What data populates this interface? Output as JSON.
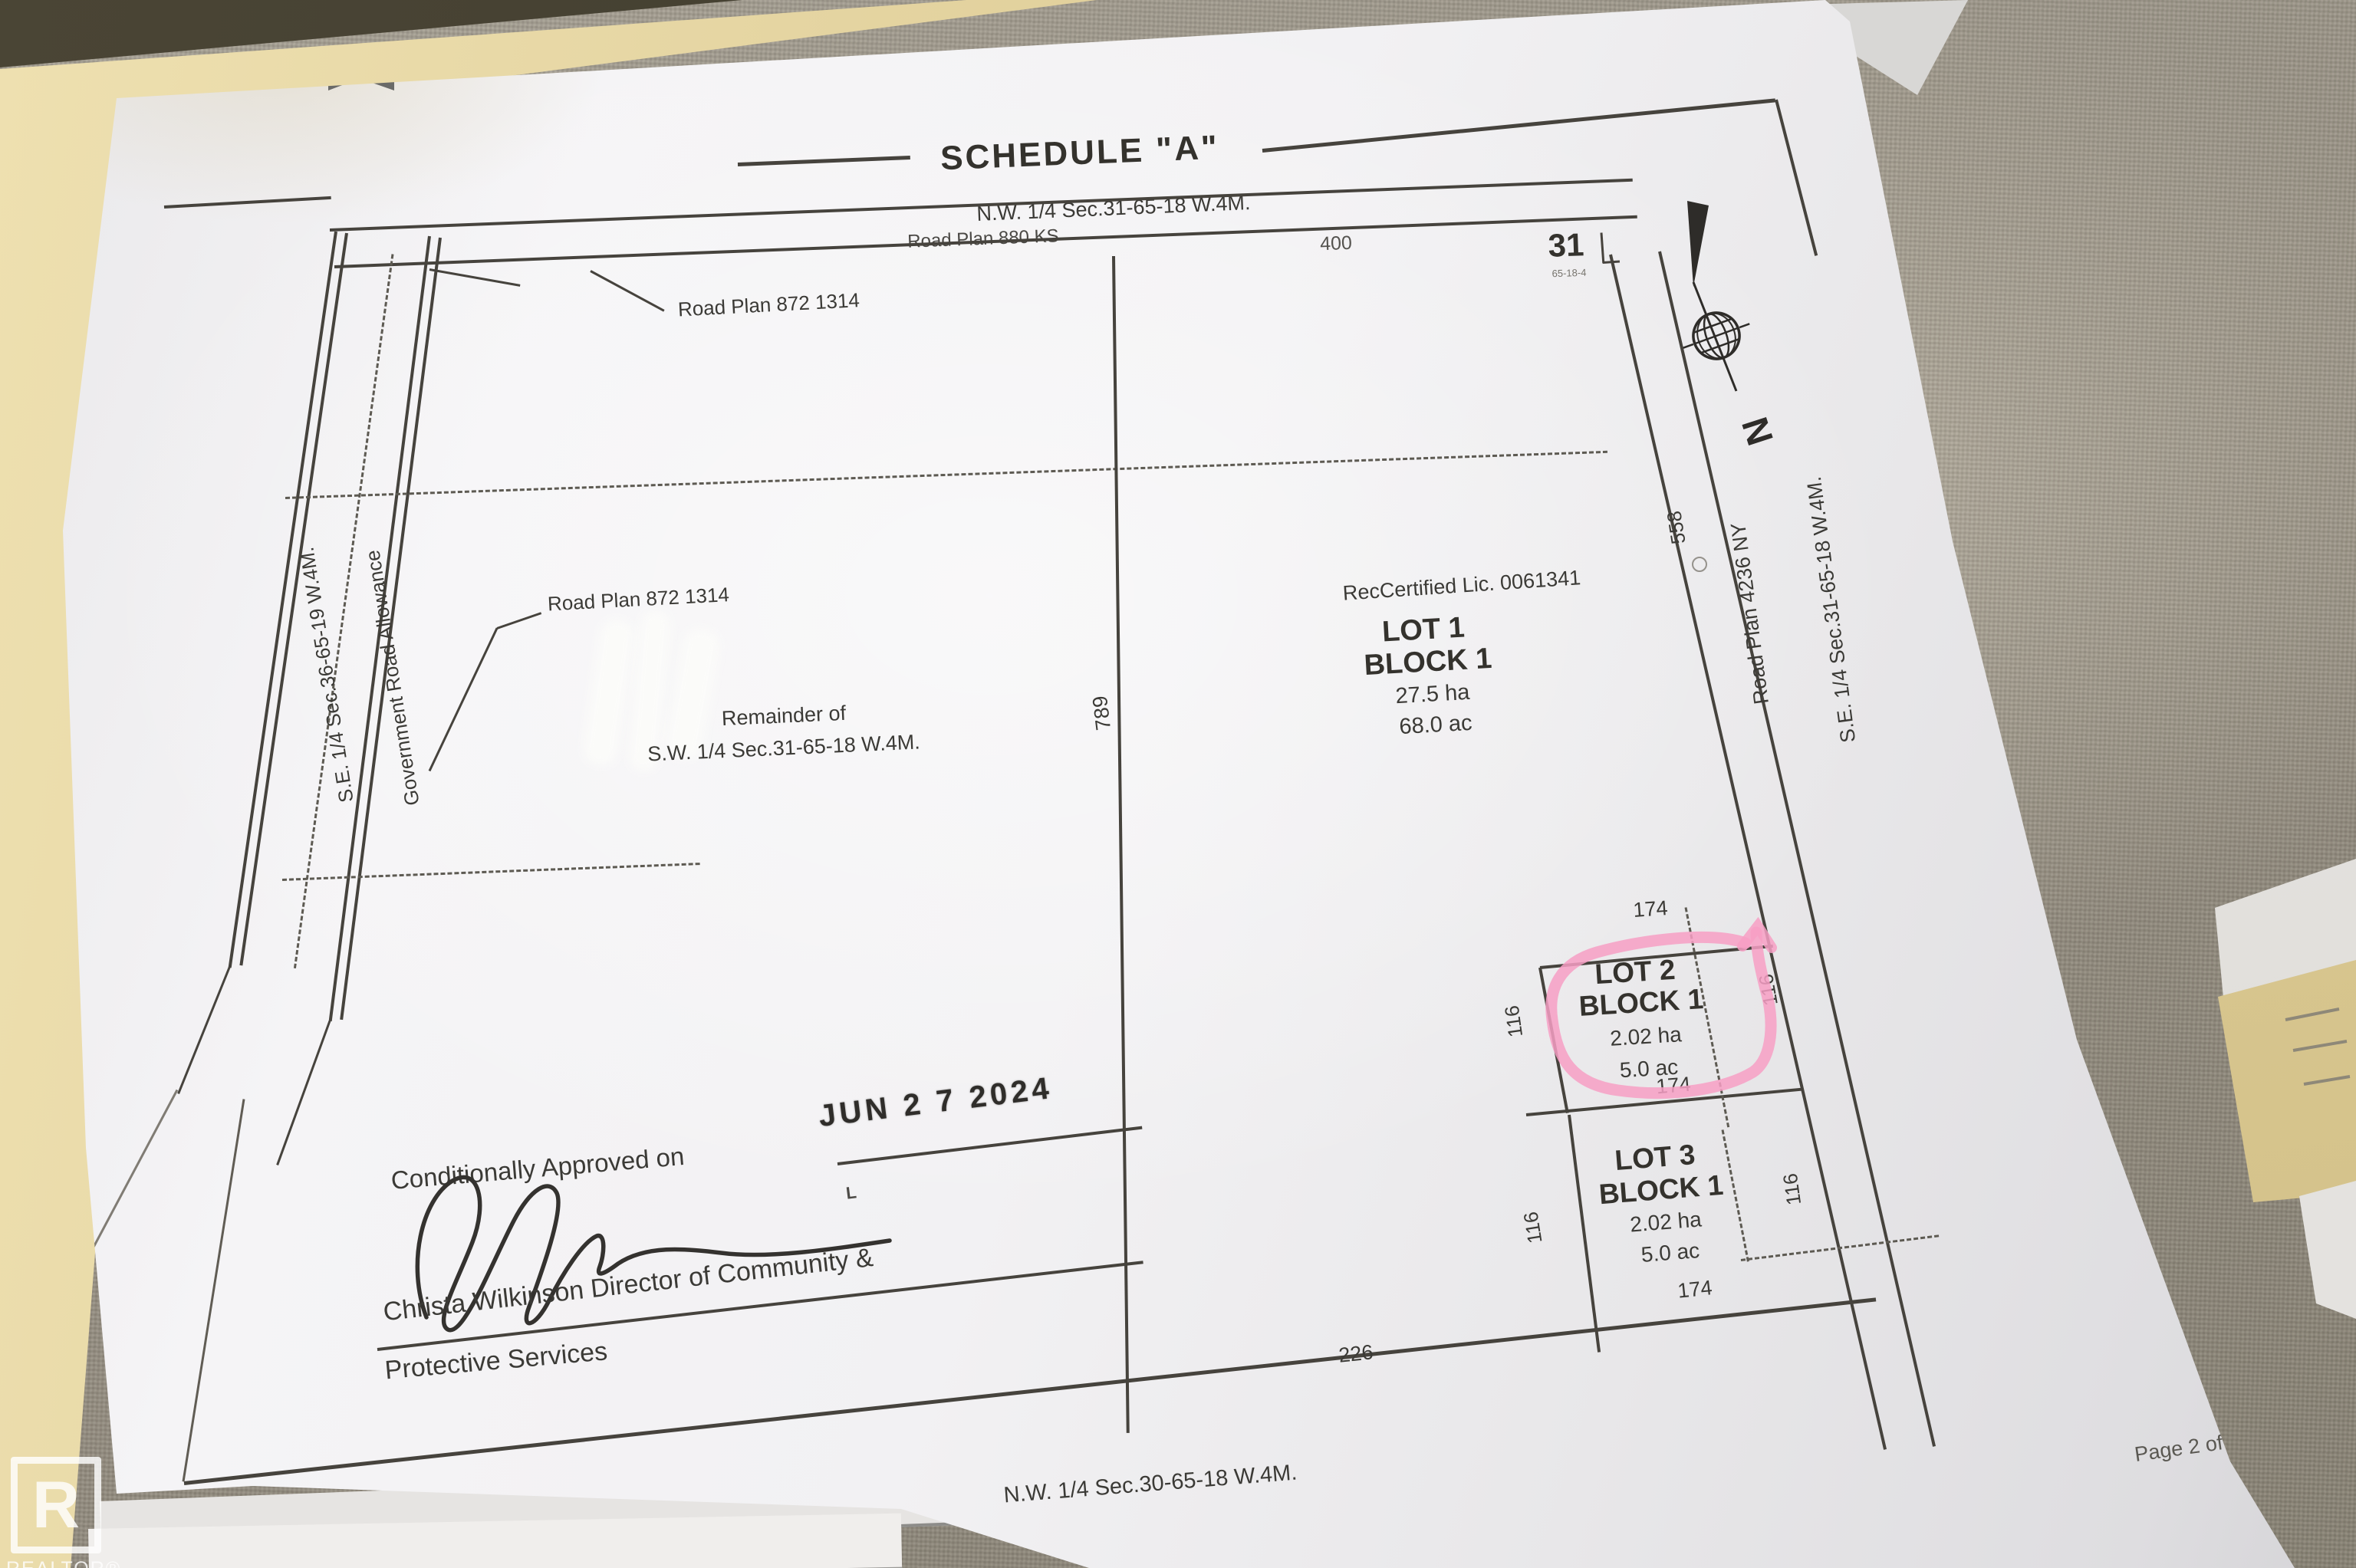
{
  "plan": {
    "title": "SCHEDULE \"A\"",
    "subtitle": "N.W. 1/4 Sec.31-65-18 W.4M.",
    "road_plan_880": "Road Plan 880 KS",
    "dim_400": "400",
    "sec31": "31",
    "sec31_sub": "65-18-4",
    "se_quarter_36": "S.E. 1/4 Sec.36-65-19 W.4M.",
    "gov_road": "Government Road Allowance",
    "road_872_a": "Road Plan 872 1314",
    "road_872_b": "Road Plan 872 1314",
    "remainder1": "Remainder of",
    "remainder2": "S.W. 1/4 Sec.31-65-18 W.4M.",
    "dim_789": "789",
    "rec_lic": "RecCertified Lic. 0061341",
    "lot1": {
      "name": "LOT 1",
      "block": "BLOCK 1",
      "area_ha": "27.5 ha",
      "area_ac": "68.0 ac"
    },
    "dim_558": "558",
    "road_4236": "Road Plan 4236 NY",
    "se_quarter_31": "S.E. 1/4 Sec.31-65-18 W.4M.",
    "north_n": "N",
    "lot2": {
      "name": "LOT 2",
      "block": "BLOCK 1",
      "area_ha": "2.02 ha",
      "area_ac": "5.0 ac",
      "top_len": "174",
      "bottom_len": "174",
      "left_len": "116",
      "right_len": "116"
    },
    "lot3": {
      "name": "LOT 3",
      "block": "BLOCK 1",
      "area_ha": "2.02 ha",
      "area_ac": "5.0 ac",
      "bottom_len": "174",
      "left_len": "116",
      "right_len": "116"
    },
    "dim_226": "226",
    "approval": {
      "text": "Conditionally Approved on",
      "date_stamp": "JUN 2 7 2024",
      "stamp_mark": "L",
      "name_line1": "Christa Wilkinson Director of Community &",
      "name_line2": "Protective Services"
    },
    "bottom_label": "N.W. 1/4 Sec.30-65-18 W.4M.",
    "page_label": "Page 2 of 2"
  },
  "watermark": {
    "logo_letter": "R",
    "logo_text": "REALTOR®"
  },
  "colors": {
    "highlight_pink": "#f79fc4",
    "ink": "#46433d",
    "paper": "#f2f1f3",
    "folder": "#e3d39e",
    "fabric": "#9b9588"
  }
}
